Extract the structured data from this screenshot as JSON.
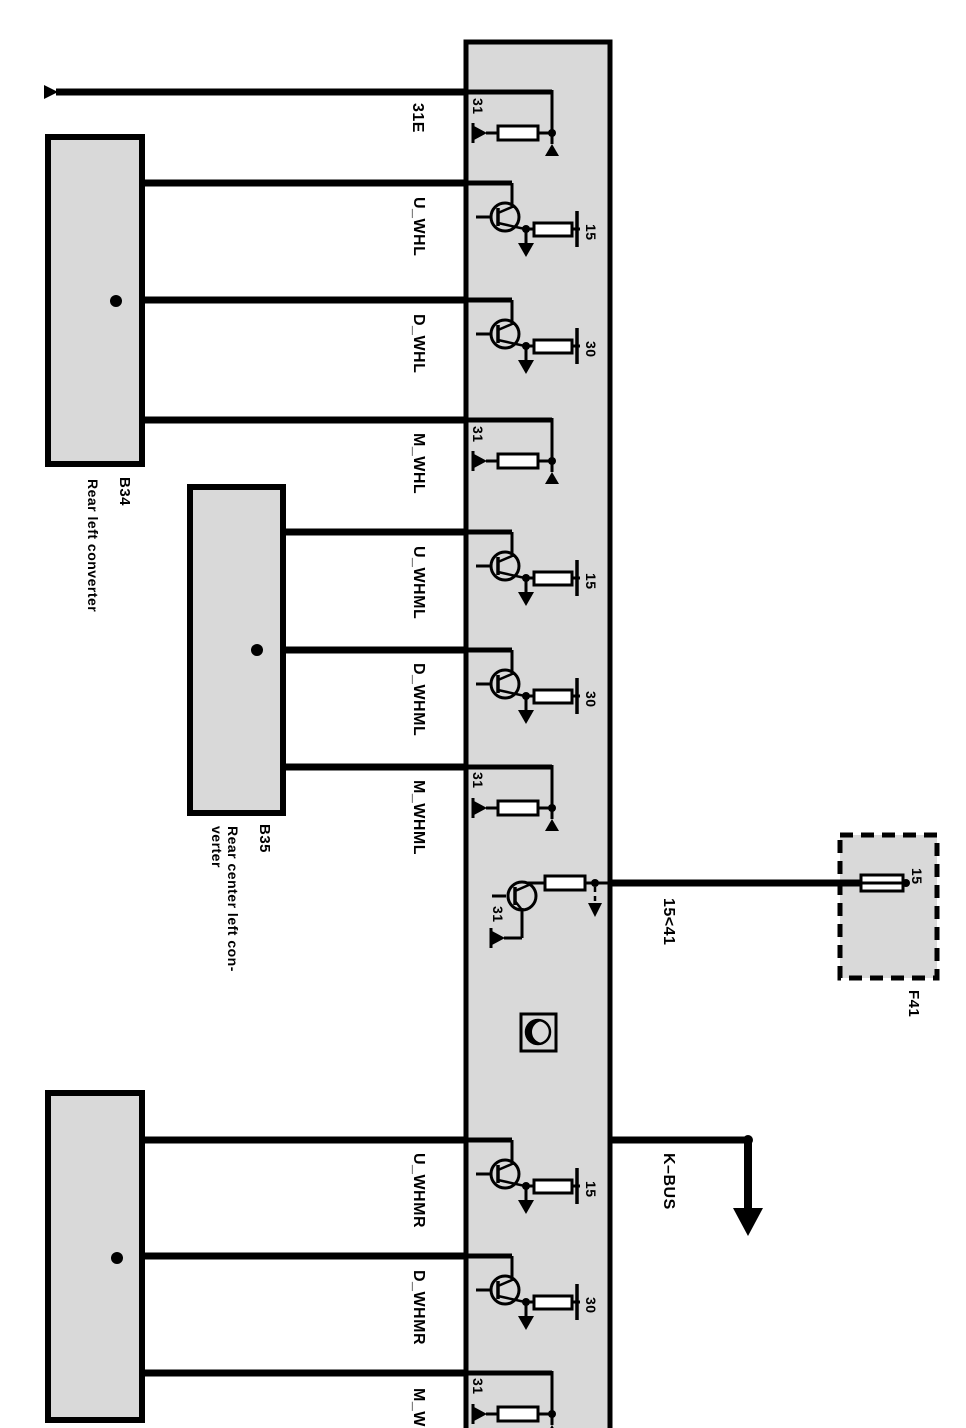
{
  "colors": {
    "module_fill": "#d9d9d9",
    "line": "#000000",
    "background": "#ffffff"
  },
  "components": {
    "b34": {
      "id": "B34",
      "name": "Rear left converter"
    },
    "b35": {
      "id": "B35",
      "name_line1": "Rear center left con-",
      "name_line2": "verter"
    },
    "f41": {
      "id": "F41",
      "fuse_terminal": "15"
    }
  },
  "internal_terminals": {
    "t31": "31",
    "t15": "15",
    "t30": "30"
  },
  "wires": {
    "w_31e": "31E",
    "w_u_whl": "U_WHL",
    "w_d_whl": "D_WHL",
    "w_m_whl": "M_WHL",
    "w_u_whml": "U_WHML",
    "w_d_whml": "D_WHML",
    "w_m_whml": "M_WHML",
    "w_u_whmr": "U_WHMR",
    "w_d_whmr": "D_WHMR",
    "w_m_whmr": "M_WHMR",
    "w_15_41": "15<41",
    "w_kbus": "K–BUS"
  }
}
